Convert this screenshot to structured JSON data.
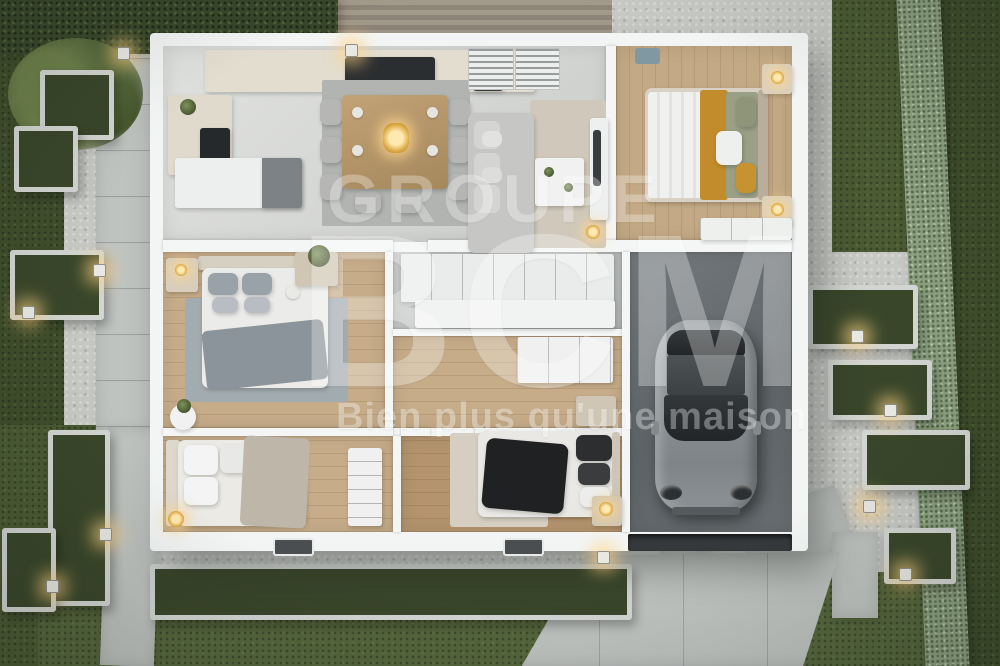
{
  "watermark": {
    "brand_top": "GROUPE",
    "brand_main": "BCM",
    "slogan": "Bien plus qu'une maison",
    "color": "#ffffff"
  },
  "scene": {
    "description": "Aerial dusk 3D render of a single-storey house floor plan, furnished, with landscaped garden, path lights and attached garage",
    "rooms": [
      {
        "name": "kitchen",
        "features": [
          "l-shaped-counter",
          "dark-cooktop",
          "island",
          "tall-dark-unit"
        ]
      },
      {
        "name": "dining-area",
        "features": [
          "wooden-table",
          "eight-chairs",
          "gray-rug",
          "lit-centerpiece"
        ]
      },
      {
        "name": "living-room",
        "features": [
          "l-shaped-gray-sofa",
          "coffee-table",
          "tv-wall-unit",
          "ceiling-vents",
          "gold-lamp"
        ]
      },
      {
        "name": "master-bedroom",
        "features": [
          "double-bed-mustard-olive-bedding",
          "two-nightstands-with-lamps",
          "wardrobe",
          "wood-floor"
        ]
      },
      {
        "name": "bedroom-2",
        "features": [
          "double-bed-gray-bedding",
          "blue-gray-rug",
          "nightstand-lamp",
          "plant-console",
          "round-side-table"
        ]
      },
      {
        "name": "bathroom",
        "features": [
          "white-wall-cabinets",
          "white-counter",
          "gray-tile-floor"
        ]
      },
      {
        "name": "hallway",
        "features": [
          "white-dresser",
          "wood-floor"
        ]
      },
      {
        "name": "bedroom-3",
        "features": [
          "double-bed-white-bedding",
          "white-desk",
          "gold-lamp"
        ]
      },
      {
        "name": "bedroom-4",
        "features": [
          "double-bed-black-throw",
          "two-nightstands",
          "beige-rug",
          "dark-wood-floor"
        ]
      },
      {
        "name": "garage",
        "features": [
          "gray-sports-car",
          "dark-concrete-floor",
          "open-garage-door"
        ]
      }
    ],
    "exterior": [
      "lawns",
      "gravel-courtyards",
      "concrete-paver-paths",
      "raised-concrete-planters",
      "ornamental-grasses",
      "tree",
      "top-hedge",
      "right-hedge",
      "wood-deck",
      "driveway",
      "cube-path-lights",
      "wall-lights",
      "two-windows-bottom-wall"
    ]
  },
  "colors": {
    "grass": "#4b5b34",
    "hedge_light": "#8da181",
    "hedge_dark": "#39482c",
    "gravel": "#c7c9c5",
    "concrete": "#bfc3c0",
    "wall_white": "#f3f5f5",
    "tile_floor": "#d5d7d4",
    "wood_floor": "#c6ac89",
    "garage_floor": "#646a6d",
    "car_body": "#8b9194",
    "accent_mustard": "#c28c2c",
    "bedding_olive": "#99a086",
    "sofa_gray": "#c6c7c5",
    "throw_black": "#1f2123",
    "light_glow": "#ffd98f"
  }
}
